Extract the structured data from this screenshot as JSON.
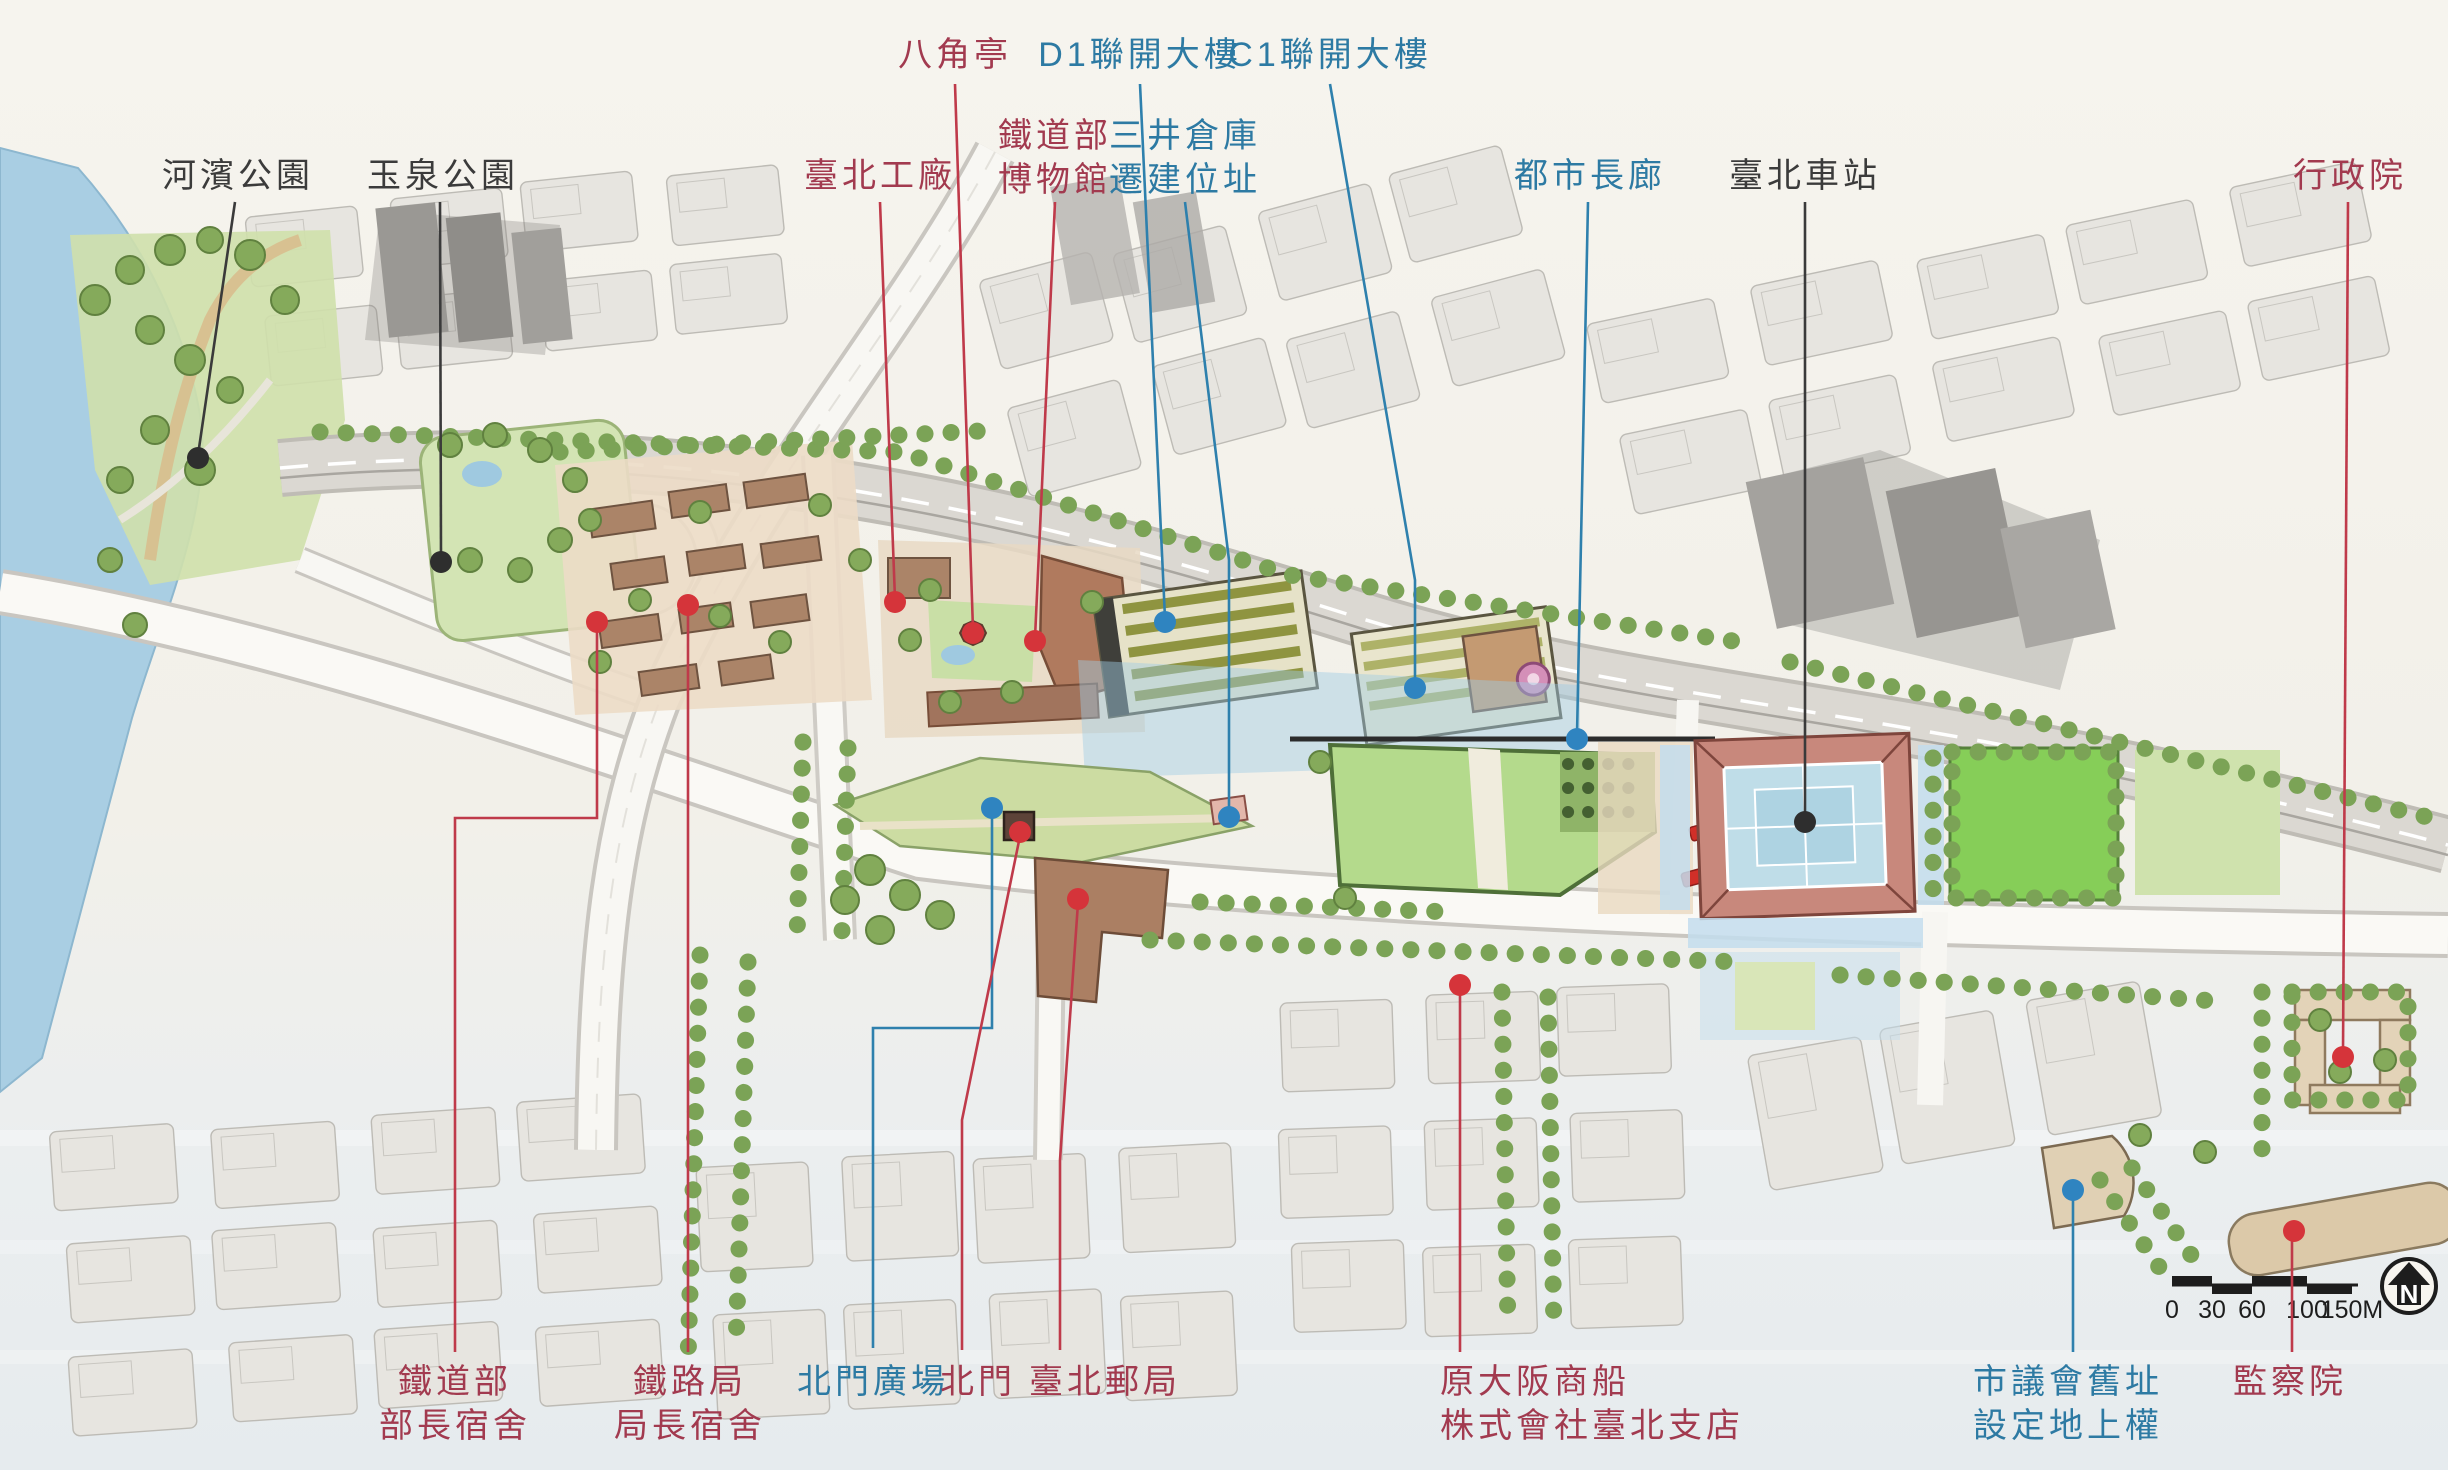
{
  "theme": {
    "label_red": "#a23a4f",
    "label_blue": "#2d7aa3",
    "label_black": "#3b3b3b",
    "paper": "#f3f1ea",
    "water": "#a9cee3",
    "lawn": "#b4da8c",
    "station_roof": "#c8887c"
  },
  "labels": [
    {
      "id": "riverside-park",
      "lines": [
        "河濱公園"
      ],
      "color": "black",
      "x": 238,
      "y": 176,
      "align": "center",
      "leader": "235,202 198,455",
      "dot": [
        198,
        458
      ]
    },
    {
      "id": "yuquan-park",
      "lines": [
        "玉泉公園"
      ],
      "color": "black",
      "x": 443,
      "y": 176,
      "align": "center",
      "leader": "440,202 441,559",
      "dot": [
        441,
        562
      ]
    },
    {
      "id": "taipei-workshop",
      "lines": [
        "臺北工廠"
      ],
      "color": "red",
      "x": 880,
      "y": 176,
      "align": "center",
      "leader": "880,202 895,599",
      "dot": [
        895,
        602
      ]
    },
    {
      "id": "octagonal-pavilion",
      "lines": [
        "八角亭"
      ],
      "color": "red",
      "x": 955,
      "y": 55,
      "align": "center",
      "leader": "955,84 973,630",
      "dot": [
        973,
        633
      ]
    },
    {
      "id": "railway-museum",
      "lines": [
        "鐵道部",
        "博物館"
      ],
      "color": "red",
      "x": 1055,
      "y": 136,
      "align": "center",
      "leader": "1055,202 1035,638",
      "dot": [
        1035,
        641
      ]
    },
    {
      "id": "d1-joint-tower",
      "lines": [
        "D1聯開大樓"
      ],
      "color": "blue",
      "x": 1140,
      "y": 55,
      "align": "center",
      "leader": "1140,84 1165,618",
      "dot": [
        1165,
        622
      ]
    },
    {
      "id": "mitsui-warehouse",
      "lines": [
        "三井倉庫",
        "遷建位址"
      ],
      "color": "blue",
      "x": 1185,
      "y": 136,
      "align": "center",
      "leader": "1185,202 1229,560 1229,814",
      "dot": [
        1229,
        817
      ]
    },
    {
      "id": "c1-joint-tower",
      "lines": [
        "C1聯開大樓"
      ],
      "color": "blue",
      "x": 1330,
      "y": 55,
      "align": "center",
      "leader": "1330,84 1415,580 1415,684",
      "dot": [
        1415,
        688
      ]
    },
    {
      "id": "urban-corridor",
      "lines": [
        "都市長廊"
      ],
      "color": "blue",
      "x": 1590,
      "y": 176,
      "align": "center",
      "leader": "1588,202 1577,735",
      "dot": [
        1577,
        739
      ]
    },
    {
      "id": "taipei-main-station",
      "lines": [
        "臺北車站"
      ],
      "color": "black",
      "x": 1805,
      "y": 176,
      "align": "center",
      "leader": "1805,202 1805,818",
      "dot": [
        1805,
        822
      ]
    },
    {
      "id": "executive-yuan",
      "lines": [
        "行政院"
      ],
      "color": "red",
      "x": 2350,
      "y": 176,
      "align": "center",
      "leader": "2348,202 2343,1053",
      "dot": [
        2343,
        1057
      ]
    },
    {
      "id": "minister-residence",
      "lines": [
        "鐵道部",
        "部長宿舍"
      ],
      "color": "red",
      "x": 455,
      "y": 1382,
      "align": "center",
      "leader": "597,626 597,818 455,818 455,1352",
      "dot": [
        597,
        622
      ]
    },
    {
      "id": "director-residence",
      "lines": [
        "鐵路局",
        "局長宿舍"
      ],
      "color": "red",
      "x": 690,
      "y": 1382,
      "align": "center",
      "leader": "688,609 688,1352",
      "dot": [
        688,
        605
      ]
    },
    {
      "id": "north-gate-plaza",
      "lines": [
        "北門廣場"
      ],
      "color": "blue",
      "x": 873,
      "y": 1382,
      "align": "center",
      "leader": "992,812 992,1028 873,1028 873,1348",
      "dot": [
        992,
        808
      ]
    },
    {
      "id": "north-gate",
      "lines": [
        "北門"
      ],
      "color": "red",
      "x": 978,
      "y": 1382,
      "align": "center",
      "leader": "1020,836 962,1120 962,1350",
      "dot": [
        1020,
        832
      ]
    },
    {
      "id": "taipei-post-office",
      "lines": [
        "臺北郵局"
      ],
      "color": "red",
      "x": 1105,
      "y": 1382,
      "align": "center",
      "leader": "1078,903 1060,1160 1060,1350",
      "dot": [
        1078,
        899
      ]
    },
    {
      "id": "osaka-shosen",
      "lines": [
        "原大阪商船",
        "株式會社臺北支店"
      ],
      "color": "red",
      "x": 1440,
      "y": 1382,
      "align": "left",
      "leader": "1460,989 1460,1352",
      "dot": [
        1460,
        985
      ]
    },
    {
      "id": "city-council-site",
      "lines": [
        "市議會舊址",
        "設定地上權"
      ],
      "color": "blue",
      "x": 2068,
      "y": 1382,
      "align": "center",
      "leader": "2073,1194 2073,1352",
      "dot": [
        2073,
        1190
      ]
    },
    {
      "id": "control-yuan",
      "lines": [
        "監察院"
      ],
      "color": "red",
      "x": 2290,
      "y": 1382,
      "align": "center",
      "leader": "2292,1235 2292,1352",
      "dot": [
        2294,
        1231
      ]
    }
  ],
  "scale_bar": {
    "y": 1285,
    "x_start": 2172,
    "x_end": 2358,
    "ticks": [
      {
        "label": "0",
        "x": 2172
      },
      {
        "label": "30",
        "x": 2212
      },
      {
        "label": "60",
        "x": 2252
      },
      {
        "label": "100",
        "x": 2307
      },
      {
        "label": "150M",
        "x": 2352
      }
    ]
  },
  "compass": {
    "letter": "N"
  }
}
